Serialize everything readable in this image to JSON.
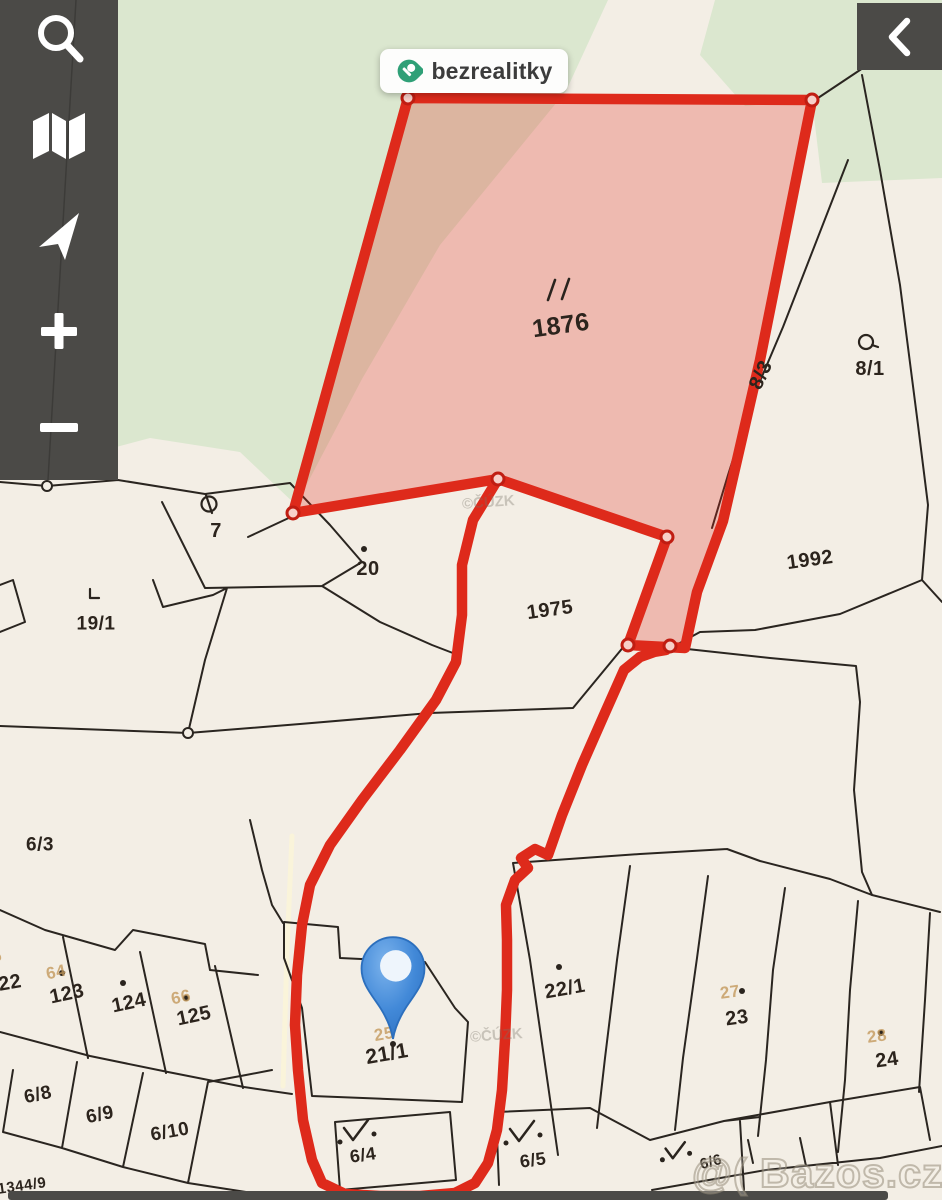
{
  "brand": {
    "label": "bezrealitky"
  },
  "sidebar": {
    "buttons": [
      {
        "id": "search",
        "icon": "search-icon"
      },
      {
        "id": "map-layers",
        "icon": "map-icon"
      },
      {
        "id": "locate",
        "icon": "navigation-arrow-icon"
      },
      {
        "id": "zoom-in",
        "icon": "plus-icon"
      },
      {
        "id": "zoom-out",
        "icon": "minus-icon"
      }
    ]
  },
  "panel_toggle": {
    "icon": "chevron-left-icon"
  },
  "map": {
    "highlighted_parcel": "1876",
    "pin_parcel": "21/1",
    "highlight_color": "#de2a1b",
    "pin_color": "#3f87d7",
    "watermarks": {
      "bazos": "@( Bazos.cz",
      "cuzk": "©ČÚZK"
    },
    "labels": [
      {
        "text": "1876",
        "x": 561,
        "y": 326,
        "rot": -8,
        "size": 25,
        "color": "dark"
      },
      {
        "text": "8/3",
        "x": 761,
        "y": 375,
        "rot": -65,
        "size": 20,
        "color": "dark"
      },
      {
        "text": "8/1",
        "x": 870,
        "y": 369,
        "rot": 0,
        "size": 20,
        "color": "dark"
      },
      {
        "text": "1992",
        "x": 810,
        "y": 560,
        "rot": -8,
        "size": 20,
        "color": "dark"
      },
      {
        "text": "1975",
        "x": 550,
        "y": 610,
        "rot": -8,
        "size": 20,
        "color": "dark"
      },
      {
        "text": "20",
        "x": 368,
        "y": 569,
        "rot": 0,
        "size": 20,
        "color": "dark"
      },
      {
        "text": "7",
        "x": 216,
        "y": 531,
        "rot": 0,
        "size": 20,
        "color": "dark"
      },
      {
        "text": "19/1",
        "x": 96,
        "y": 624,
        "rot": 0,
        "size": 19,
        "color": "dark"
      },
      {
        "text": "6/3",
        "x": 40,
        "y": 845,
        "rot": 0,
        "size": 19,
        "color": "dark"
      },
      {
        "text": "22",
        "x": 10,
        "y": 983,
        "rot": -10,
        "size": 20,
        "color": "dark"
      },
      {
        "text": "123",
        "x": 67,
        "y": 994,
        "rot": -12,
        "size": 20,
        "color": "dark"
      },
      {
        "text": "124",
        "x": 129,
        "y": 1003,
        "rot": -12,
        "size": 20,
        "color": "dark"
      },
      {
        "text": "125",
        "x": 194,
        "y": 1016,
        "rot": -12,
        "size": 20,
        "color": "dark"
      },
      {
        "text": "6/8",
        "x": 38,
        "y": 1095,
        "rot": -12,
        "size": 19,
        "color": "dark"
      },
      {
        "text": "6/9",
        "x": 100,
        "y": 1115,
        "rot": -12,
        "size": 19,
        "color": "dark"
      },
      {
        "text": "6/10",
        "x": 170,
        "y": 1132,
        "rot": -10,
        "size": 19,
        "color": "dark"
      },
      {
        "text": "1344/9",
        "x": 22,
        "y": 1186,
        "rot": -8,
        "size": 15,
        "color": "dark"
      },
      {
        "text": "21/1",
        "x": 387,
        "y": 1054,
        "rot": -10,
        "size": 21,
        "color": "dark"
      },
      {
        "text": "22/1",
        "x": 565,
        "y": 989,
        "rot": -10,
        "size": 20,
        "color": "dark"
      },
      {
        "text": "23",
        "x": 737,
        "y": 1018,
        "rot": -8,
        "size": 20,
        "color": "dark"
      },
      {
        "text": "24",
        "x": 887,
        "y": 1060,
        "rot": -8,
        "size": 20,
        "color": "dark"
      },
      {
        "text": "6/4",
        "x": 363,
        "y": 1155,
        "rot": -8,
        "size": 18,
        "color": "dark"
      },
      {
        "text": "6/5",
        "x": 533,
        "y": 1160,
        "rot": -8,
        "size": 18,
        "color": "dark"
      },
      {
        "text": "6/6",
        "x": 711,
        "y": 1162,
        "rot": -15,
        "size": 15,
        "color": "dark"
      },
      {
        "text": "65",
        "x": -8,
        "y": 957,
        "rot": -12,
        "size": 17,
        "color": "orange"
      },
      {
        "text": "64",
        "x": 56,
        "y": 972,
        "rot": -12,
        "size": 17,
        "color": "orange"
      },
      {
        "text": "66",
        "x": 181,
        "y": 997,
        "rot": -12,
        "size": 17,
        "color": "orange"
      },
      {
        "text": "25",
        "x": 384,
        "y": 1034,
        "rot": -10,
        "size": 17,
        "color": "orange"
      },
      {
        "text": "27",
        "x": 730,
        "y": 992,
        "rot": -8,
        "size": 17,
        "color": "orange"
      },
      {
        "text": "28",
        "x": 877,
        "y": 1036,
        "rot": -8,
        "size": 17,
        "color": "orange"
      }
    ],
    "symbols": [
      {
        "type": "dslash",
        "x": 557,
        "y": 290
      },
      {
        "type": "ring-slash",
        "x": 209,
        "y": 504
      },
      {
        "type": "ring-tail",
        "x": 866,
        "y": 342
      },
      {
        "type": "corner",
        "x": 92,
        "y": 596
      },
      {
        "type": "dot",
        "x": 364,
        "y": 549
      },
      {
        "type": "dot",
        "x": 559,
        "y": 967
      },
      {
        "type": "dot",
        "x": 742,
        "y": 991
      },
      {
        "type": "dot",
        "x": 881,
        "y": 1033
      },
      {
        "type": "dot",
        "x": 62,
        "y": 973
      },
      {
        "type": "dot",
        "x": 123,
        "y": 983
      },
      {
        "type": "dot",
        "x": 186,
        "y": 998
      },
      {
        "type": "dot",
        "x": 393,
        "y": 1044
      },
      {
        "type": "check",
        "x": 357,
        "y": 1131,
        "s": 1
      },
      {
        "type": "check",
        "x": 523,
        "y": 1132,
        "s": 1
      },
      {
        "type": "check",
        "x": 676,
        "y": 1151,
        "s": 0.8
      }
    ]
  }
}
